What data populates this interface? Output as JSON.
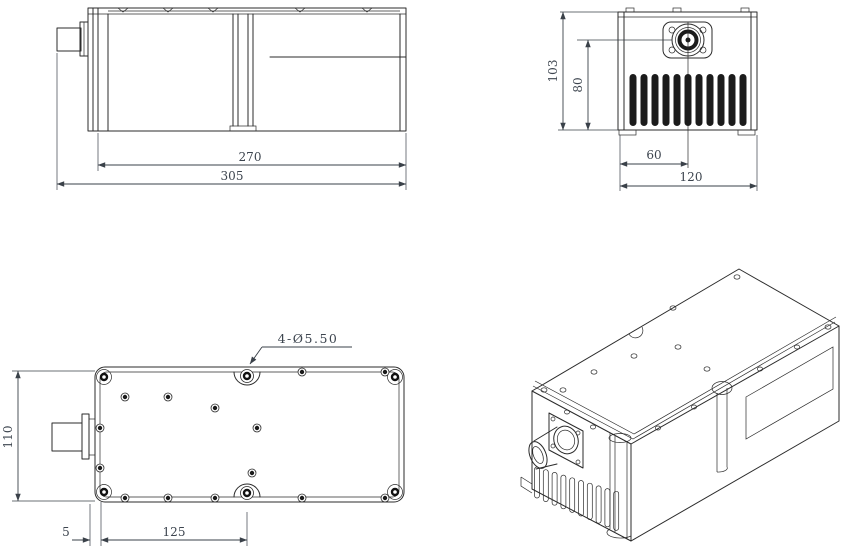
{
  "views": {
    "side_view": {
      "dim_body_length": "270",
      "dim_overall_length": "305"
    },
    "front_view": {
      "dim_overall_height": "103",
      "dim_connector_center_height": "80",
      "dim_connector_center_offset": "60",
      "dim_overall_width": "120"
    },
    "top_view": {
      "dim_overall_depth": "110",
      "dim_mount_hole_edge_offset": "5",
      "dim_mount_hole_spacing": "125",
      "mount_hole_callout": "4-Ø5.50"
    }
  },
  "colors": {
    "line": "#2b2b2b",
    "dimension_text": "#3d454f",
    "background": "#ffffff"
  }
}
